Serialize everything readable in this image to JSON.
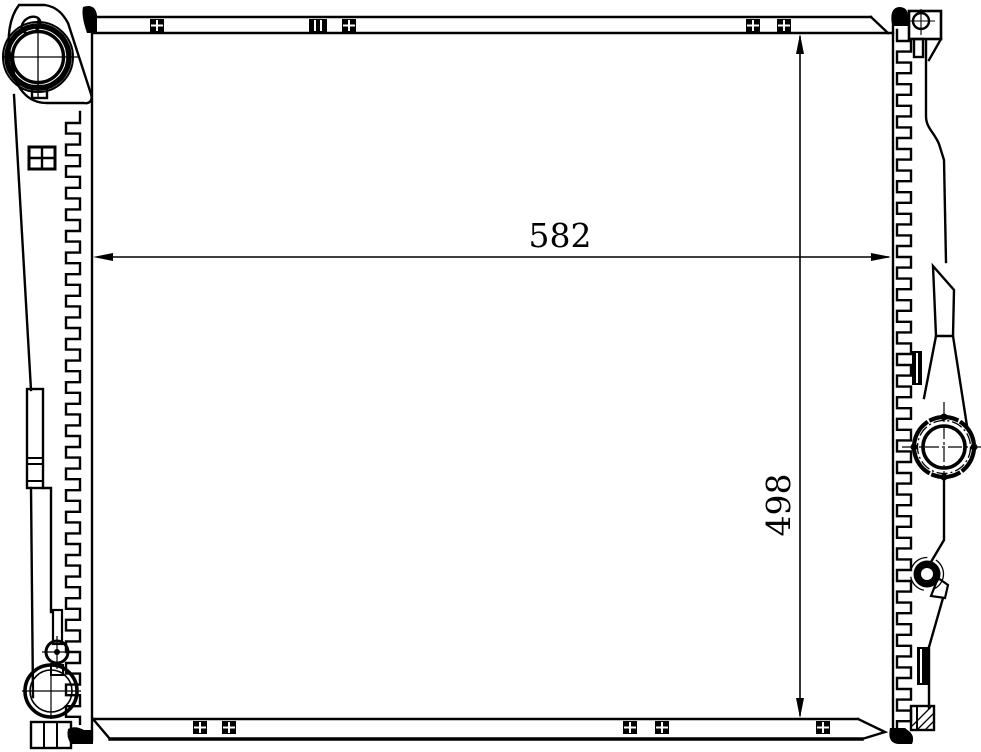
{
  "diagram": {
    "type": "technical-line-drawing",
    "subject": "radiator front view",
    "line_color": "#000000",
    "background_color": "#ffffff",
    "dimensions": {
      "width_label": "582",
      "height_label": "498"
    }
  }
}
